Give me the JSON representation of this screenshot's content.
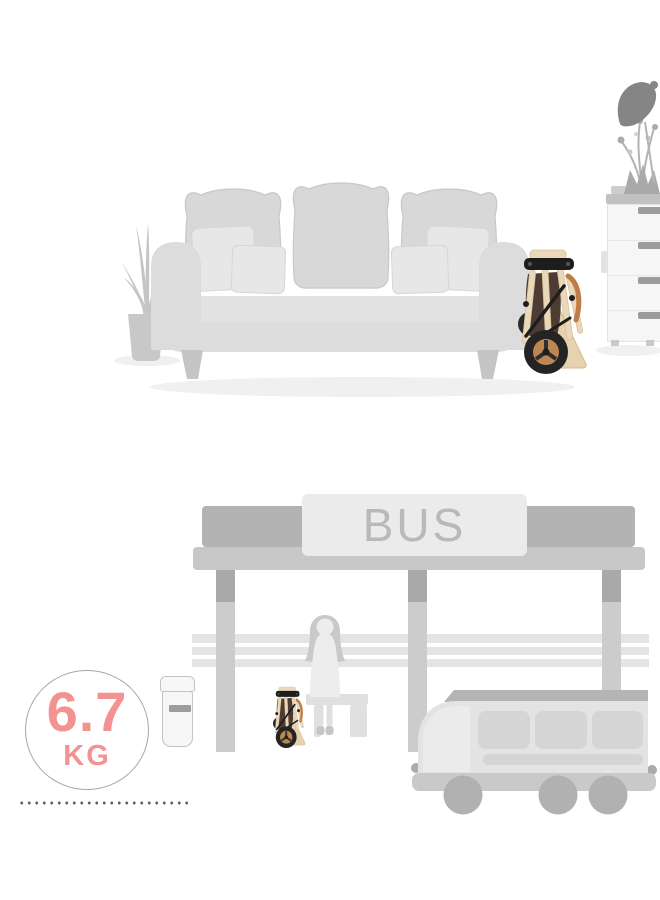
{
  "bus_stop": {
    "sign_label": "BUS"
  },
  "weight_badge": {
    "value": "6.7",
    "unit": "KG",
    "accent_color": "#f29391",
    "ring_color": "#a8a8a8"
  },
  "palette": {
    "background": "#ffffff",
    "furniture_gray": "#d8d8d8",
    "structure_gray": "#c7c7c7",
    "dark_gray": "#a9a9a9",
    "lamp_gray": "#858585",
    "stroller_cream": "#ead8ba",
    "stroller_tan": "#bf8350",
    "stroller_black": "#242424",
    "stroller_brown": "#4d3c33",
    "dot_gray": "#5f5f5f"
  },
  "icons": {
    "living_room": [
      "floor-plant-icon",
      "sofa-icon",
      "folded-stroller-icon",
      "drawer-chest-icon",
      "vase-plant-icon",
      "desk-lamp-icon"
    ],
    "bus_stop": [
      "bus-shelter-icon",
      "bus-sign-icon",
      "bench-icon",
      "waiting-person-icon",
      "folded-stroller-icon",
      "trash-bin-icon",
      "bus-icon",
      "weight-badge-icon",
      "dotted-line-icon"
    ]
  }
}
